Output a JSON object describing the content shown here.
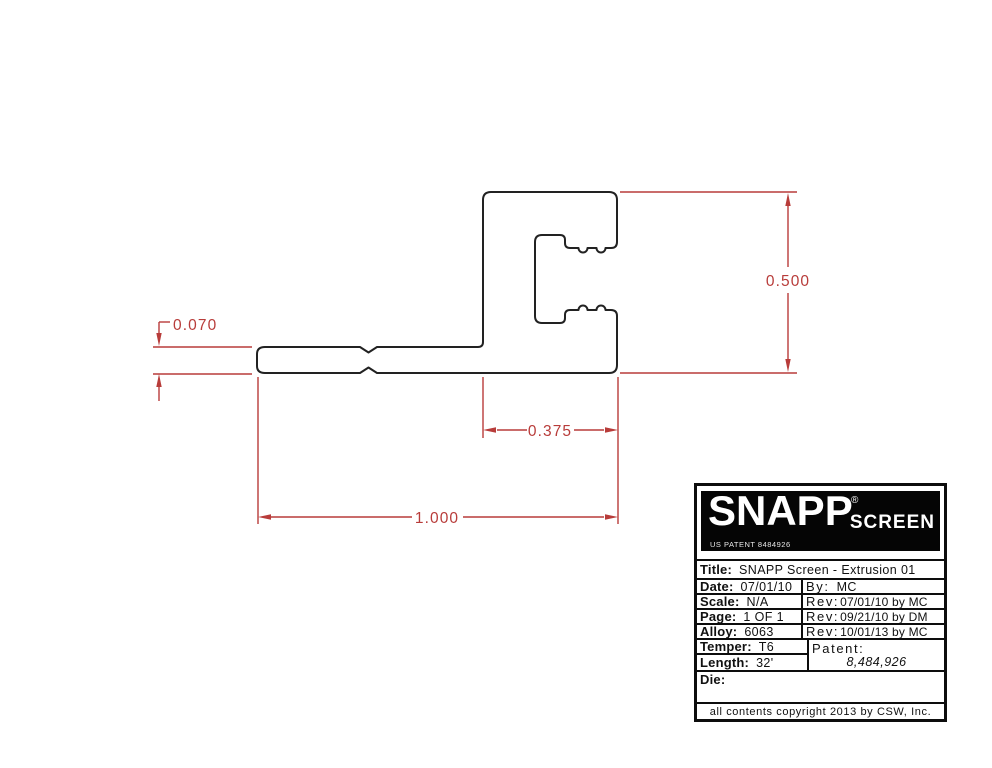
{
  "colors": {
    "outline": "#222222",
    "dimension_red": "#b83c3a",
    "logo_background": "#050505",
    "logo_text": "#ffffff"
  },
  "drawing": {
    "dim_overall_height": "0.500",
    "dim_leg_thickness": "0.070",
    "dim_channel_width": "0.375",
    "dim_overall_width": "1.000"
  },
  "title_block": {
    "logo": {
      "brand": "SNAPP",
      "reg_mark": "®",
      "brand2": "SCREEN",
      "patent_note": "US PATENT 8484926"
    },
    "title": {
      "label": "Title:",
      "value": "SNAPP Screen - Extrusion 01"
    },
    "date": {
      "label": "Date:",
      "value": "07/01/10"
    },
    "by": {
      "label": "By:",
      "value": "MC"
    },
    "scale": {
      "label": "Scale:",
      "value": "N/A"
    },
    "rev1": {
      "label": "Rev:",
      "value": "07/01/10 by MC"
    },
    "page": {
      "label": "Page:",
      "value": "1 OF 1"
    },
    "rev2": {
      "label": "Rev:",
      "value": "09/21/10 by DM"
    },
    "alloy": {
      "label": "Alloy:",
      "value": "6063"
    },
    "rev3": {
      "label": "Rev:",
      "value": "10/01/13 by MC"
    },
    "temper": {
      "label": "Temper:",
      "value": "T6"
    },
    "patent": {
      "label": "Patent:",
      "value": "8,484,926"
    },
    "length": {
      "label": "Length:",
      "value": "32'"
    },
    "die": {
      "label": "Die:",
      "value": ""
    },
    "footer": "all contents copyright 2013 by CSW, Inc."
  }
}
